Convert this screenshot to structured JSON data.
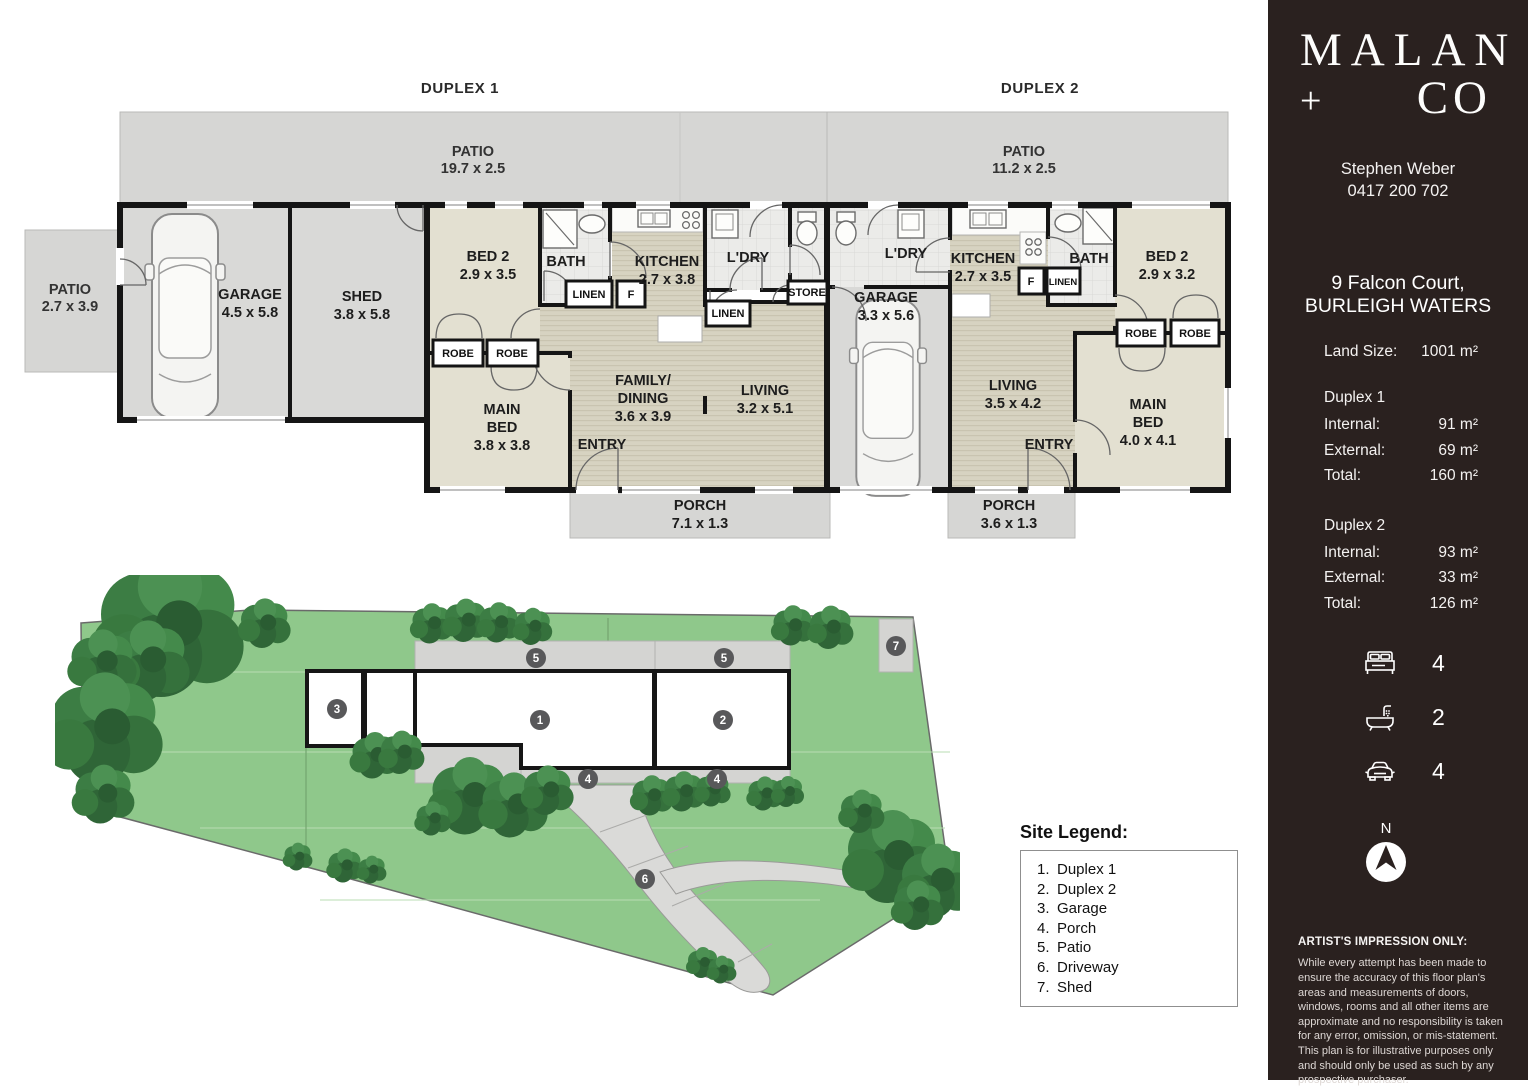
{
  "floorplan": {
    "duplex1": {
      "title": "DUPLEX 1",
      "patio_top": {
        "name": "PATIO",
        "dims": "19.7 x 2.5"
      },
      "patio_side": {
        "name": "PATIO",
        "dims": "2.7 x 3.9"
      },
      "garage": {
        "name": "GARAGE",
        "dims": "4.5 x 5.8"
      },
      "shed": {
        "name": "SHED",
        "dims": "3.8 x 5.8"
      },
      "bed2": {
        "name": "BED 2",
        "dims": "2.9 x 3.5"
      },
      "bath": "BATH",
      "linen1": "LINEN",
      "fridge": "F",
      "kitchen": {
        "name": "KITCHEN",
        "dims": "2.7 x 3.8"
      },
      "ldry": "L'DRY",
      "store": "STORE",
      "linen2": "LINEN",
      "robe1": "ROBE",
      "robe2": "ROBE",
      "main_bed": {
        "l1": "MAIN",
        "l2": "BED",
        "dims": "3.8 x 3.8"
      },
      "entry": "ENTRY",
      "family": {
        "l1": "FAMILY/",
        "l2": "DINING",
        "dims": "3.6 x 3.9"
      },
      "living": {
        "name": "LIVING",
        "dims": "3.2 x 5.1"
      },
      "porch": {
        "name": "PORCH",
        "dims": "7.1 x 1.3"
      }
    },
    "duplex2": {
      "title": "DUPLEX 2",
      "patio_top": {
        "name": "PATIO",
        "dims": "11.2 x 2.5"
      },
      "ldry": "L'DRY",
      "garage": {
        "name": "GARAGE",
        "dims": "3.3 x 5.6"
      },
      "kitchen": {
        "name": "KITCHEN",
        "dims": "2.7 x 3.5"
      },
      "fridge": "F",
      "linen": "LINEN",
      "bath": "BATH",
      "bed2": {
        "name": "BED 2",
        "dims": "2.9 x 3.2"
      },
      "robe1": "ROBE",
      "robe2": "ROBE",
      "living": {
        "name": "LIVING",
        "dims": "3.5 x 4.2"
      },
      "entry": "ENTRY",
      "main_bed": {
        "l1": "MAIN",
        "l2": "BED",
        "dims": "4.0 x 4.1"
      },
      "porch": {
        "name": "PORCH",
        "dims": "3.6 x 1.3"
      }
    }
  },
  "siteplan": {
    "markers": [
      "1",
      "2",
      "3",
      "4",
      "4",
      "5",
      "5",
      "6",
      "7"
    ]
  },
  "legend": {
    "title": "Site Legend:",
    "items": [
      {
        "num": "1.",
        "label": "Duplex 1"
      },
      {
        "num": "2.",
        "label": "Duplex 2"
      },
      {
        "num": "3.",
        "label": "Garage"
      },
      {
        "num": "4.",
        "label": "Porch"
      },
      {
        "num": "5.",
        "label": "Patio"
      },
      {
        "num": "6.",
        "label": "Driveway"
      },
      {
        "num": "7.",
        "label": "Shed"
      }
    ]
  },
  "sidebar": {
    "logo": {
      "line1": "MALAN",
      "plus": "+",
      "line2": "CO"
    },
    "agent_name": "Stephen Weber",
    "agent_phone": "0417 200 702",
    "address_line1": "9 Falcon Court,",
    "address_line2": "BURLEIGH WATERS",
    "land_size_label": "Land Size:",
    "land_size_value": "1001 m²",
    "duplex1": {
      "title": "Duplex 1",
      "rows": [
        {
          "label": "Internal:",
          "value": "91 m²"
        },
        {
          "label": "External:",
          "value": "69 m²"
        },
        {
          "label": "Total:",
          "value": "160 m²"
        }
      ]
    },
    "duplex2": {
      "title": "Duplex 2",
      "rows": [
        {
          "label": "Internal:",
          "value": "93 m²"
        },
        {
          "label": "External:",
          "value": "33 m²"
        },
        {
          "label": "Total:",
          "value": "126 m²"
        }
      ]
    },
    "stats": {
      "beds": "4",
      "baths": "2",
      "cars": "4"
    },
    "compass_label": "N",
    "disclaimer_title": "ARTIST'S IMPRESSION ONLY:",
    "disclaimer_body": "While every attempt has been made to ensure the accuracy of this floor plan's areas and measurements of doors, windows, rooms and all other items are approximate and no responsibility is taken for any error, omission, or mis-statement. This plan is for illustrative purposes only and should only be used as such by any prospective purchaser.",
    "accent_dark": "#2a211f"
  }
}
